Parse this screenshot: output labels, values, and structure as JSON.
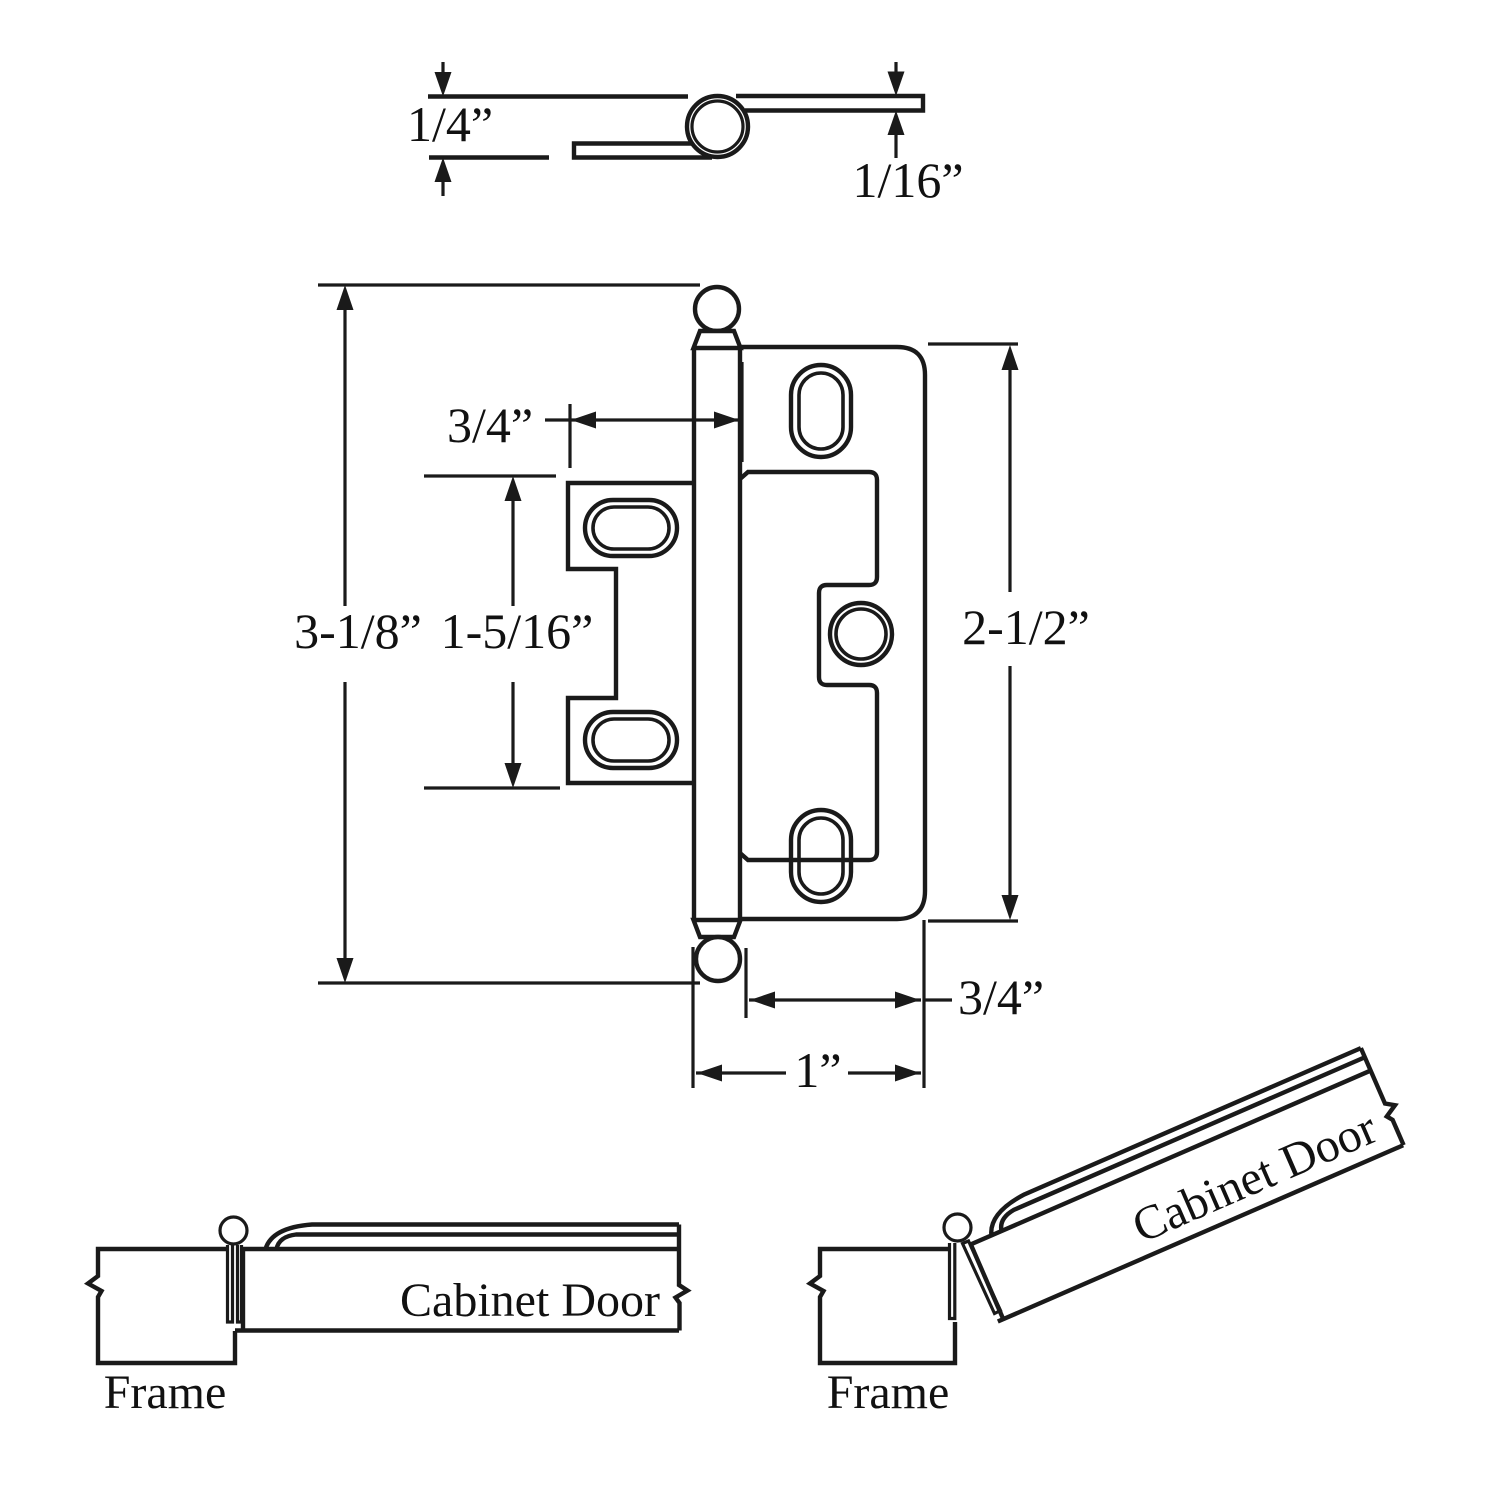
{
  "page": {
    "background": "#ffffff",
    "line_color": "#1a1a1a",
    "description": "Cabinet hinge dimension drawing with side profile, front view and two mounting illustrations"
  },
  "side_view": {
    "dim_leaf_offset": "1/4”",
    "dim_leaf_thickness": "1/16”"
  },
  "front_view": {
    "dim_overall_height": "3-1/8”",
    "dim_door_wing_height": "1-5/16”",
    "dim_door_wing_width": "3/4”",
    "dim_frame_wing_height": "2-1/2”",
    "dim_screw_offset": "3/4”",
    "dim_frame_wing_width": "1”"
  },
  "closed_view": {
    "frame_label": "Frame",
    "door_label": "Cabinet Door"
  },
  "open_view": {
    "frame_label": "Frame",
    "door_label": "Cabinet Door"
  }
}
